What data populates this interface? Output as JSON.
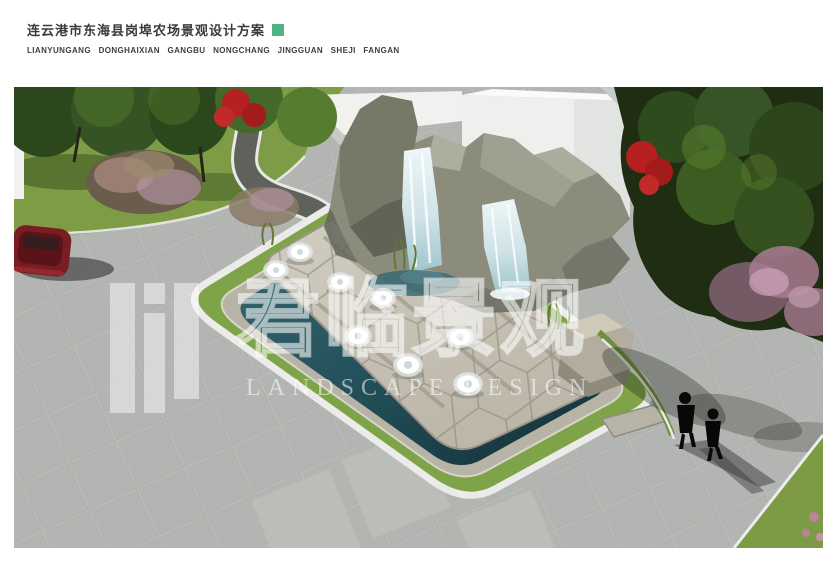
{
  "header": {
    "title": "连云港市东海县岗埠农场景观设计方案",
    "subtitle": "LIANYUNGANG DONGHAIXIAN GANGBU NONGCHANG JINGGUAN SHEJI FANGAN",
    "accent_square_color": "#4db381"
  },
  "rendering": {
    "alt": "Aerial 3D rendering of a rockery waterfall fountain plaza with hexagonal stone terraces, surrounding reflecting pool, lawns, trees, a red car and two pedestrians",
    "watermark": {
      "logo_name": "landscape-studio-logo",
      "text_cn": "君临景观",
      "text_en": "LANDSCAPE DESIGN",
      "color": "rgba(255,255,255,0.55)"
    },
    "scene_colors": {
      "plaza_paving": "#b3b5b2",
      "asphalt_path": "#5f625c",
      "curb_white": "#ebebe9",
      "lawn_green": "#7d9c45",
      "tree_dark_green": "#2c471b",
      "tree_light_green": "#567d2f",
      "flower_red": "#b52020",
      "flower_pink": "#b58fa4",
      "building_white": "#f0f1ef",
      "rock_gray_green": "#8b8c7c",
      "stone_platform": "#c9c5b8",
      "pool_water_teal": "#23505a",
      "waterfall_white": "#dfeef2",
      "car_dark_red": "#7a1d22",
      "pedestrian_black": "#080808"
    }
  }
}
